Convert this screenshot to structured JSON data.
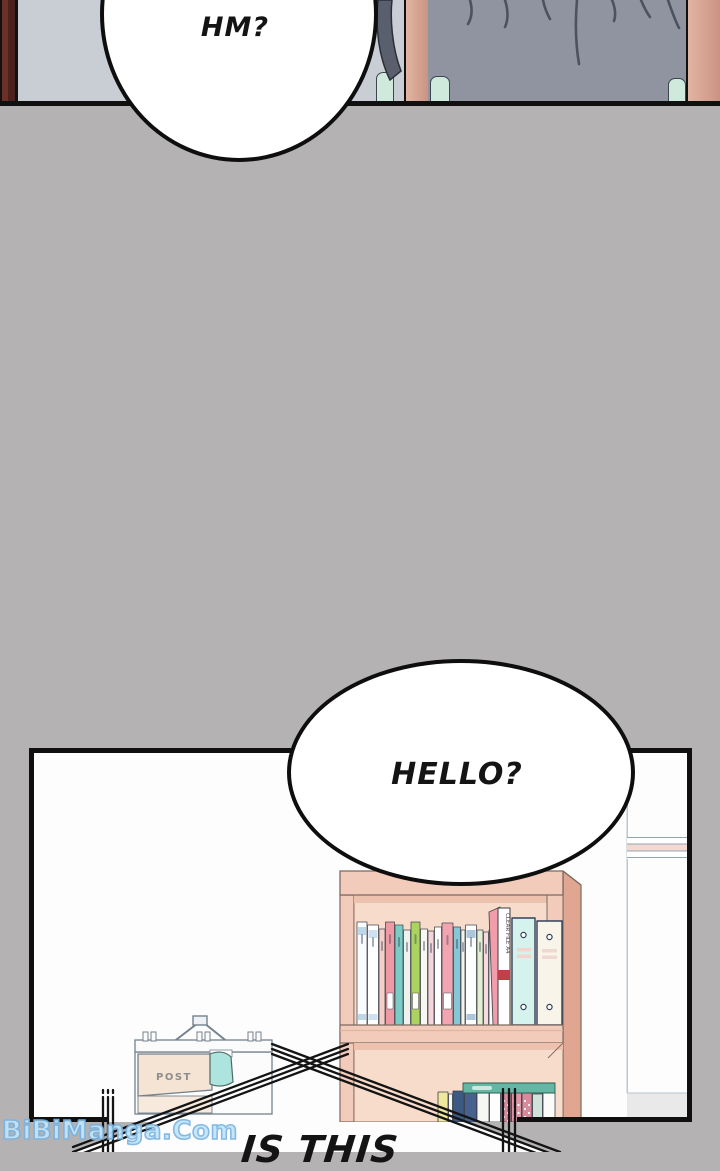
{
  "bubbles": {
    "hm": "HM?",
    "hello": "HELLO?",
    "shout_line1": "IS THIS"
  },
  "watermark": {
    "text": "BiBiManga.Com",
    "fill": "#c2e6fa",
    "outline": "#79b4e2"
  },
  "post_box": {
    "label": "POST"
  },
  "bookshelf": {
    "top_row": {
      "clear_file_label": "CLEAR FILE A4",
      "books": [
        {
          "w": 10,
          "h": 103,
          "c": "#f8fcff",
          "band": "#bcd7e8"
        },
        {
          "w": 11,
          "h": 100,
          "c": "#ffffff",
          "band": "#cfe0ee"
        },
        {
          "w": 6,
          "h": 96,
          "c": "#f4cfc8"
        },
        {
          "w": 9,
          "h": 103,
          "c": "#ee9aa6",
          "label": true
        },
        {
          "w": 8,
          "h": 100,
          "c": "#79cdc6"
        },
        {
          "w": 7,
          "h": 95,
          "c": "#edf3ec"
        },
        {
          "w": 9,
          "h": 103,
          "c": "#aad45f",
          "label": true
        },
        {
          "w": 7,
          "h": 96,
          "c": "#f7f7f2"
        },
        {
          "w": 6,
          "h": 94,
          "c": "#f4d6da"
        },
        {
          "w": 7,
          "h": 98,
          "c": "#fdfdfd"
        },
        {
          "w": 11,
          "h": 102,
          "c": "#f2a5b0",
          "label": true
        },
        {
          "w": 7,
          "h": 98,
          "c": "#84c7d7"
        },
        {
          "w": 4,
          "h": 95,
          "c": "#f4f4ee"
        },
        {
          "w": 11,
          "h": 100,
          "c": "#fbfdff",
          "band": "#a9c6dd"
        },
        {
          "w": 6,
          "h": 95,
          "c": "#e1efd3"
        },
        {
          "w": 5,
          "h": 93,
          "c": "#f6dade"
        },
        {
          "w": 4,
          "h": 95,
          "c": "#fafafa"
        }
      ],
      "binders": [
        {
          "c": "#d6f2ec"
        },
        {
          "c": "#f8f4ea"
        }
      ]
    },
    "bottom_row": {
      "books": [
        {
          "w": 10,
          "h": 30,
          "c": "#efe79c"
        },
        {
          "w": 4,
          "h": 28,
          "c": "#f7f7f7"
        },
        {
          "w": 11,
          "h": 31,
          "c": "#3d5a84"
        },
        {
          "w": 12,
          "h": 31,
          "c": "#47628c"
        },
        {
          "w": 12,
          "h": 30,
          "c": "#f6f6f2"
        },
        {
          "w": 11,
          "h": 32,
          "c": "#fdfdfd"
        },
        {
          "w": 10,
          "h": 29,
          "c": "#d8899a",
          "dots": true
        },
        {
          "w": 10,
          "h": 29,
          "c": "#df93a3",
          "dots": true
        },
        {
          "w": 10,
          "h": 29,
          "c": "#d8899a",
          "dots": true
        },
        {
          "w": 10,
          "h": 28,
          "c": "#cfe3da"
        },
        {
          "w": 12,
          "h": 30,
          "c": "#fbfbf9"
        }
      ]
    }
  },
  "colors": {
    "gutter": "#b4b2b2",
    "panel_bg": "#fdfdfd",
    "line": "#101010",
    "wall": "#c9ced5",
    "door_dark": "#4a211d",
    "door_light": "#6b3129",
    "salmon_light": "#e3b4a2",
    "salmon_dark": "#c89181",
    "hair": "#8f94a0",
    "hair_line": "#4d5260",
    "mint": "#cfe9dd",
    "wood": "#f2cbba",
    "wood_side": "#e0a692",
    "wood_interior": "#f7dccb",
    "wood_shadow": "#ecc2af",
    "wood_outline": "#7d6a60",
    "trim_pink": "#f3d9d2",
    "trim_line": "#93a5b1",
    "floor_gray": "#e9e9e9",
    "seam": "#b9c2ca",
    "binder_cyan": "#d6f2ec",
    "binder_white": "#f8f4ea",
    "binder_edge": "#32415a",
    "flat_book": "#63b7a4",
    "letter_teal": "#aee4de",
    "box_outline": "#74828e",
    "box_flap": "#f5e3d3",
    "post_text": "#8e8e8e",
    "red_band": "#c04048",
    "wm_fill": "#c2e6fa",
    "wm_outline": "#79b4e2"
  }
}
